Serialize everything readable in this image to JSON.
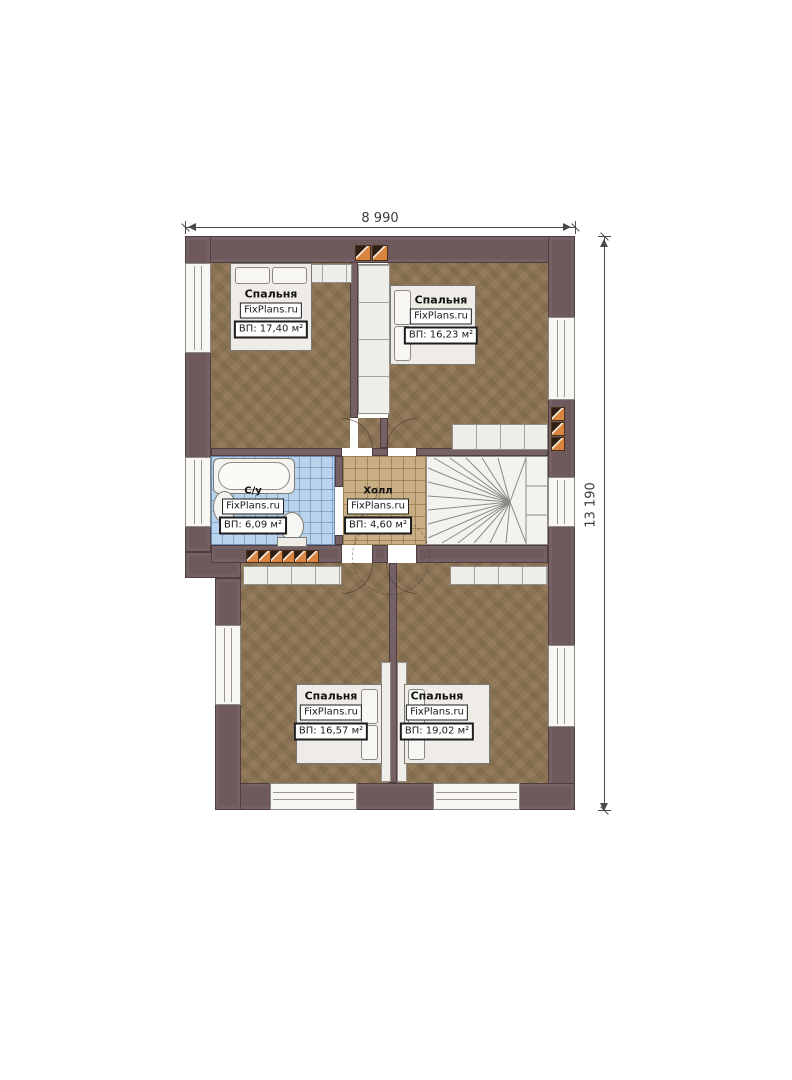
{
  "title": "Floor plan second floor",
  "dimensions": {
    "width": "8 990",
    "height": "13 190"
  },
  "rooms": {
    "bedroom_top_left": {
      "name": "Спальня",
      "brand": "FixPlans.ru",
      "area": "ВП: 17,40 м²"
    },
    "bedroom_top_right": {
      "name": "Спальня",
      "brand": "FixPlans.ru",
      "area": "ВП: 16,23 м²"
    },
    "bathroom": {
      "name": "С/у",
      "brand": "FixPlans.ru",
      "area": "ВП: 6,09 м²"
    },
    "hall": {
      "name": "Холл",
      "brand": "FixPlans.ru",
      "area": "ВП: 4,60 м²"
    },
    "bedroom_bottom_left": {
      "name": "Спальня",
      "brand": "FixPlans.ru",
      "area": "ВП: 16,57 м²"
    },
    "bedroom_bottom_right": {
      "name": "Спальня",
      "brand": "FixPlans.ru",
      "area": "ВП: 19,02 м²"
    }
  },
  "colors": {
    "wall": "#6e595c",
    "floor": "#8b7355",
    "bath_tile": "#b9d3ec",
    "hall_tile": "#c9ae84",
    "chimney": "#d9853f"
  }
}
